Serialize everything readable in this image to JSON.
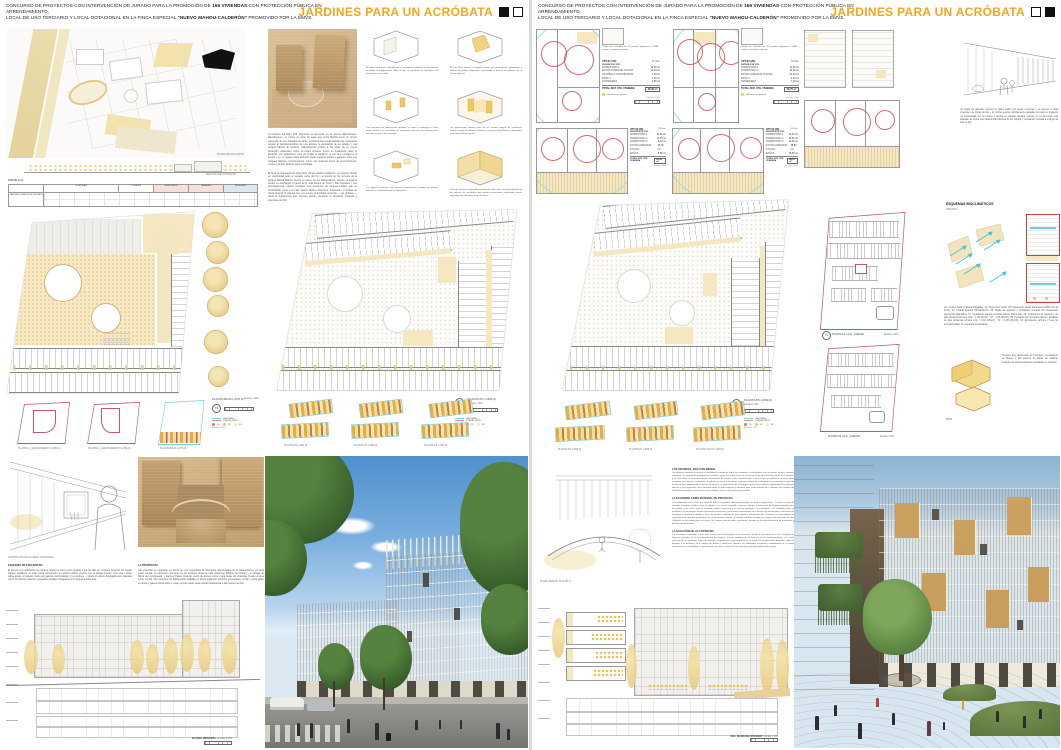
{
  "accent_color": "#F2A71B",
  "header": {
    "line1_a": "CONCURSO DE PROYECTOS CON INTERVENCIÓN DE JURADO PARA LA PROMOCIÓN DE ",
    "line1_b": "166 VIVIENDAS",
    "line1_c": " CON PROTECCIÓN PÚBLICA EN ARRENDAMIENTO,",
    "line2_a": "LOCAL DE USO TERCIARIO Y LOCAL DOTACIONAL EN LA FINCA ESPECIAL ",
    "line2_b": "“NUEVO MAHOU-CALDERÓN”",
    "line2_c": " PROMOVIDO POR LA EMVS.",
    "title": "JARDINES PARA UN ACRÓBATA"
  },
  "left": {
    "site": {
      "plan_label": "PLANO DE SITUACIÓN",
      "section_label": "SECCIÓN DE SITUACIÓN"
    },
    "table": {
      "title": "PARCELA (A)",
      "row_label": "JARDINES PARA UN ACRÓBATA",
      "groups": [
        "VIVIENDAS",
        "LOCALES",
        "TRASTEROS",
        "GARAJES",
        "RESUMEN"
      ]
    },
    "intro1": "A principios del Siglo XVII, Francisco de Quevedo, en su poema «Manzanares, Manzanares», se refiere al curso de agua que cruza Madrid como un arroyo «aprendiz de río». Pasados los años, el Manzanares renaturalizado ha conseguido reparar el antropocentrismo de una autovía, la demolición de su estadio y una antigua fábrica de cerveza, reabsorbiendo incluso a las obras de un nuevo desarrollo urbanístico sobre su ribera próxima. Como un funámbulo sobre el alquitrán, con agitaciones, pero sin perder el equilibrio, el eco de la ciudad en el tiempo y en el espacio hace alcanzar ahora nuestras plazas y parques sobre sus antiguas fábricas. Construyamos, como una moderna forma de reconocimiento, nuevos y fértiles jardines para el acróbata.",
    "intro2": "El Área de Planeamiento Específico «Nuevo Mahou-Calderón» se propone liberar de continuidad tanto el espacio verde del río y el interior de los terrenos de la antigua fábrica Mahou. Desde el paseo de los Melancólicos, nuevos corredores verdes se despliegan a través de la calle Duque de Tovar y San Cayetano y sus prolongaciones, tejidos mediante una secuencia de parques-mirador que se consolidarán junto a la calle Casino Mahou. Entonces, finalmente, el paisaje de ribera alcanza la parcela que nos ocupa: el acróbata asciende — los jardines — hacia la arquitectura que, siempre atenta, presiente el descanso profundo y silencioso del Río.",
    "diagrams": [
      "El orden volumétrico definido por la normativa establece un basamento vinculado al equipamiento sobre el que se organizan las viviendas con alineación a tres calles.",
      "El área libre interior se propone como una prolongación geométrica y natural del parque adyacente, conectando el acceso en esquina con el Paseo Imperial.",
      "Con conjuntos de plazas-patio apiladas se alzan y prolongan el área verde interior y se consolidan los elementos verticales de comunicación que dan acceso a las viviendas.",
      "Las plazas-patio forman parte de un sistema integral de ventilación natural a base de galerías interiores y especies bioclimáticas apropiadas en el nivel umbral interno.",
      "Las galerías conectan con espacios colaborativos situados en plantas diversas y a disposición de los habitantes.",
      "Una piel exterior transpirable envuelve la edificación, una derivada del ala de galerías de ventilación que genera privacidades adecuadas desde experimentos climáticos muy concretos."
    ],
    "planA": {
      "label": "PLANTA BAJA (+576,0)",
      "scale": "Escala 1:300"
    },
    "planB": {
      "label": "PLANTA P1 (+581,0)",
      "scale": "Escala 1:300"
    },
    "smallA": [
      "PLANTA 2 _EQUIPAMIENTO (+586,0)",
      "PLANTA 1 _EQUIPAMIENTO (+581,0)",
      "PLANTA BAJA (+576,0)"
    ],
    "smallB": [
      "PLANTA P2 (+584,0)",
      "PLANTA P3 (+587,0)",
      "PLANTA P4 (+590,0)"
    ],
    "legend": {
      "g": "GALERÍAS",
      "p": "PLAZAS-PATIO",
      "t1": "1D",
      "t2": "2D",
      "t3": "3D",
      "scale": "Escala 1:750"
    },
    "sketch_label": "VESTÍBULOS DE ACCESO, PORTALES",
    "texts": [
      {
        "h": "ESQUEMA DE ENCUENTRO",
        "p": "El acceso a la edificación se produce desde un único punto situado a pie de calle en el Paseo Imperial. Un amplio zaguán establece un nodo social conectando el espacio público exterior con el paisaje interior. Una cota y doble altura desde el zaguán, hacia las galerías bioclimáticas y los jardines — plaza en altura. Equipamientos laterales como dormitorios, talleres o pequeños portales integrados en la propia arquitectura."
      },
      {
        "h": "LA PROPUESTA",
        "p": "Las viviendas se organizan en forma de «U» respetando la volumetría determinada por el planeamiento. Un área verde central, en ascensión con aires de los parques desde la calle Caramuel (Mahou Sur-Oeste) y el paisaje de ribera de la propuesta; y hacia el Paseo Imperial, punto de acceso común para todas las viviendas. Desde el área verde central, dos conjuntos de plazas-patio apiladas en altura organizan cambios elementales: portal + plaza jardín en altura + galería bioclimática + casa; permite situar cada unidad habitacional a las puertas del Río."
      }
    ],
    "elevation": {
      "label": "ALZADO PRINCIPAL",
      "scale": "Escala 1:300"
    }
  },
  "right": {
    "note1": "*Todas las viviendas de 1D pueden adaptarse a PMR según el esquema superior.",
    "note2": "*Todas las viviendas de 2D pueden adaptarse a PMR según el esquema superior.",
    "types": [
      {
        "code": "VPT-01 (1D)",
        "units": "27 Uds.",
        "sup": "SUPERFICIE ÚTIL",
        "rows": [
          [
            "DORMITORIO 1",
            "11,96 m²"
          ],
          [
            "ESTAR-COMEDOR-COCINA",
            "22,40 m²"
          ],
          [
            "VESTÍBULO-DISTRIBUIDOR",
            "2,84 m²"
          ],
          [
            "BAÑO 1",
            "4,60 m²"
          ],
          [
            "TENDEDERO",
            "4,55 m²"
          ]
        ],
        "total_label": "TOTAL SUP. ÚTIL VIVIENDA",
        "total": "46,35 m²",
        "scale": "Escala 1:100",
        "loc": "Ubicación en plantas"
      },
      {
        "code": "VPT-02 (2D)",
        "units": "79 Uds.",
        "sup": "SUPERFICIE ÚTIL",
        "rows": [
          [
            "DORMITORIO 1",
            "11,96 m²"
          ],
          [
            "DORMITORIO 2",
            "10,25 m²"
          ],
          [
            "ESTAR-COMEDOR-COCINA",
            "24,60 m²"
          ],
          [
            "BAÑO 1",
            "4,60 m²"
          ],
          [
            "TENDEDERO",
            "7,29 m²"
          ]
        ],
        "total_label": "TOTAL SUP. ÚTIL VIVIENDA",
        "total": "58,70 m²",
        "scale": "Escala 1:100",
        "loc": "Ubicación en plantas"
      },
      {
        "code": "VPT-03 (3D)",
        "units": "29 Uds.",
        "sup": "SUPERFICIE ÚTIL",
        "rows": [
          [
            "DORMITORIO 1",
            "11,96 m²"
          ],
          [
            "DORMITORIO 2",
            "10,25 m²"
          ],
          [
            "DORMITORIO 3",
            "8,10 m²"
          ],
          [
            "ESTAR-COMEDOR-COCINA",
            "25,40 m²"
          ],
          [
            "BAÑOS",
            "6,59 m²"
          ]
        ],
        "total_label": "TOTAL SUP. ÚTIL VIVIENDA",
        "total": "62,30 m²",
        "scale": "Escala 1:100",
        "loc": "Ubicación en plantas"
      },
      {
        "code": "VPT-04 (3D)",
        "units": "31 Uds.",
        "sup": "SUPERFICIE ÚTIL",
        "rows": [
          [
            "DORMITORIO 1",
            "13,10 m²"
          ],
          [
            "DORMITORIO 2",
            "11,20 m²"
          ],
          [
            "DORMITORIO 3",
            "10,45 m²"
          ],
          [
            "ESTAR-COMEDOR-COCINA",
            "38,60 m²"
          ],
          [
            "BAÑOS",
            "15,35 m²"
          ]
        ],
        "total_label": "TOTAL SUP. ÚTIL VIVIENDA",
        "total": "88,70 m²",
        "scale": "Escala 1:100",
        "loc": "Ubicación en plantas"
      }
    ],
    "gallery_note": "Un tejido de galerías conecta la plaza jardín con áreas comunes y el acceso a cada vivienda. Las zonas de día y de noche quedan debidamente aisladas. El estar se organiza en continuidad con la cocina y resitúa el espacio mirador exterior en la dirección más soleada, de forma que cada unidad disfruta de luz natural y ventilación cruzada a lo largo de todo el día.",
    "planC": {
      "label": "PLANTA P5 (+593,0)",
      "scale": "Escala 1:300"
    },
    "smallC": [
      "PLANTA P6 (+596,0)",
      "PLANTA P7 (+599,0)",
      "PLANTA ÁTICO (+602,0)"
    ],
    "legend": {
      "g": "GALERÍAS",
      "p": "PLAZAS-PATIO",
      "t1": "1D",
      "t2": "2D",
      "t3": "3D",
      "scale": "Escala 1:750"
    },
    "parking": [
      {
        "label": "PLANTA S1 (-3,0) _GARAJE",
        "scale": "Escala 1:600"
      },
      {
        "label": "PLANTA S2 (-6,0) _GARAJE",
        "scale": "Escala 1:600"
      }
    ],
    "bio": {
      "title": "ESQUEMAS BIOCLIMÁTICOS",
      "season": "VERANO",
      "legend": "01. Control Solar (Celosía Plegable). 02. Protección Solar. 03. Protección viento dominante O/SW (11-19 km/h). 04. Unidad Exterior Climatización. 05. Rejilla de apertura y ventilación cruzada. 06. Vegetación perimetral adaptativa. 07. Ventilación natural cruzada (efecto chimenea). 08. Carpintería de madera y de alta eficiencia térmica (Uw < 1,43 W/m²K · Uf < 1,43 W/m²K). 09. Persiana tipo corredera (lamas, abatible) de alta eficiencia térmica (Ug < 0,62 W/m²K · Uf < 1,85 W/m²K). 10. Envolvente térmica y losa de termoactividad. 11. Lámpara bioclimática."
    },
    "tipo": {
      "label": "TIPO",
      "note": "Trastero tipo. Estructura de hormigón, cerramiento de bloque y piel exterior de lamas de madera; módulos de almacenamiento ventilados en cubierta."
    },
    "texts": [
      {
        "h": "LOS SISTEMAS, MÁS CON MENOS",
        "p": "Las galerías interiores permiten la ventilación cruzada de todas las viviendas, vinculándolas con las plazas jardín y terrazas exteriores. La vegetación ambiental se incorpora como una infraestructura al servicio de la pre-climatización de las viviendas, y no solo como un mero instrumento ornamental. En verano, cada usuario decide si abrir, cerrar o modular la corriente entre el interior y el exterior; en invierno, la galería se cierra a las zonas comunes exteriores, reduciendo la envolvente térmica de la edificación y optimizando su factor de forma. La conservación de la energía resulta trascendental, trabajando la envolvente térmica y las carpinterías de la fachada norte; un lado continuo y eficiente para cada orientación. Cuidamos los jardines del mundo interrumpido y las emisiones de carbono: ésta es una buena oportunidad."
      },
      {
        "h": "LA ECONOMÍA COMO MATERIAL DE PROYECTO",
        "p": "Decía Alejandro de la Sota que «aquello que es aceptable, difícilmente puede ser buena arquitectura». Cuando se trata de vivienda protegida, pública, para su alquiler a un precio asequible, conviene atender a esta razón de proporcionalidad entre los medios y los fines; entre la inversión pública necesaria y el servicio prestado a la ciudadanía. Los «Jardines para un acróbata» se construyen desde argumentos esenciales y soluciones contrastadas en este tipo de promociones: estructura de hormigón, cerramiento soporte a base de paneles o bloque de gran formato; aislamiento por el exterior en continuidad con carpinterías de aluminio equipadas con contraventana exterior, y fachada ventilada acabada en chapa color terracota; el color «Madrid» en las anotaciones de Goya. Un sistema generalizado, económico, basado en la industrialización de elementos y de fácil mantenimiento."
      },
      {
        "h": "LA SOLUCIÓN DE LO COTIDIANO",
        "p": "Las viviendas responden a esta idea esencial de la búsqueda de la economía: desde la gravedad de la «U» reflejada en fajancas parciales, el aire perfumado por los jardines, el buen rendimiento de apertura de las contraventanas, o la visión nocturna de las gestiones sobre las terrazas; aceptamos la experiencia fácil y la sabiduría atemporal de materiales sobre la bandeja o la cerámica. A la alegría de barrio y superficies blandas los habitantes responden amablemente a su mejor conveniencia y comodidad; su personalización como la última de las estrategias de apropiación del espacio."
      }
    ],
    "sketch_label": "PLAZA JARDÍN. PLANTA 1ª",
    "section": {
      "label": "SEC. MANZANA INTERIOR",
      "scale": "Escala 1:300"
    }
  }
}
